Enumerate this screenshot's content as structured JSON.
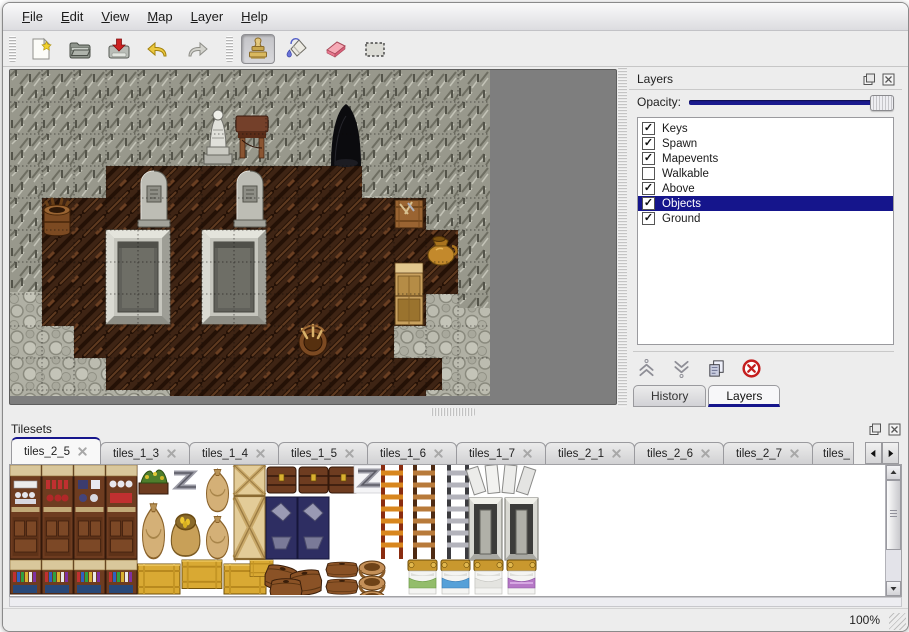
{
  "menu": {
    "items": [
      {
        "label": "File"
      },
      {
        "label": "Edit"
      },
      {
        "label": "View"
      },
      {
        "label": "Map"
      },
      {
        "label": "Layer"
      },
      {
        "label": "Help"
      }
    ]
  },
  "toolbar": {
    "groups": [
      {
        "buttons": [
          {
            "name": "new",
            "icon": "new-file-icon"
          },
          {
            "name": "open",
            "icon": "open-folder-icon"
          },
          {
            "name": "save",
            "icon": "save-icon"
          },
          {
            "name": "undo",
            "icon": "undo-icon"
          },
          {
            "name": "redo",
            "icon": "redo-icon"
          }
        ]
      },
      {
        "buttons": [
          {
            "name": "stamp-tool",
            "icon": "stamp-tool-icon",
            "active": true
          },
          {
            "name": "fill-tool",
            "icon": "fill-tool-icon"
          },
          {
            "name": "eraser-tool",
            "icon": "eraser-tool-icon"
          },
          {
            "name": "select-tool",
            "icon": "select-tool-icon"
          }
        ]
      }
    ]
  },
  "map_view": {
    "tile_size": 32,
    "visible_objects": [
      "statue",
      "table",
      "cave-entrance",
      "gravestone",
      "gravestone",
      "stone-altar",
      "stone-altar",
      "barrel",
      "crate",
      "golden-vase",
      "wooden-shelf",
      "barrel-with-tools"
    ]
  },
  "layers_panel": {
    "title": "Layers",
    "opacity_label": "Opacity:",
    "opacity_percent": 100,
    "layers": [
      {
        "name": "Keys",
        "checked": true,
        "selected": false
      },
      {
        "name": "Spawn",
        "checked": true,
        "selected": false
      },
      {
        "name": "Mapevents",
        "checked": true,
        "selected": false
      },
      {
        "name": "Walkable",
        "checked": false,
        "selected": false
      },
      {
        "name": "Above",
        "checked": true,
        "selected": false
      },
      {
        "name": "Objects",
        "checked": true,
        "selected": true
      },
      {
        "name": "Ground",
        "checked": true,
        "selected": false
      }
    ],
    "buttons": [
      {
        "name": "move-layer-up",
        "icon": "chevrons-up-icon"
      },
      {
        "name": "move-layer-down",
        "icon": "chevrons-down-icon"
      },
      {
        "name": "duplicate-layer",
        "icon": "duplicate-icon"
      },
      {
        "name": "delete-layer",
        "icon": "delete-icon"
      }
    ],
    "tabs": [
      {
        "label": "History",
        "active": false
      },
      {
        "label": "Layers",
        "active": true
      }
    ]
  },
  "tilesets_panel": {
    "title": "Tilesets",
    "tabs": [
      {
        "label": "tiles_2_5",
        "active": true,
        "truncated": false
      },
      {
        "label": "tiles_1_3",
        "active": false,
        "truncated": false
      },
      {
        "label": "tiles_1_4",
        "active": false,
        "truncated": false
      },
      {
        "label": "tiles_1_5",
        "active": false,
        "truncated": false
      },
      {
        "label": "tiles_1_6",
        "active": false,
        "truncated": false
      },
      {
        "label": "tiles_1_7",
        "active": false,
        "truncated": false
      },
      {
        "label": "tiles_2_1",
        "active": false,
        "truncated": false
      },
      {
        "label": "tiles_2_6",
        "active": false,
        "truncated": false
      },
      {
        "label": "tiles_2_7",
        "active": false,
        "truncated": false
      },
      {
        "label": "tiles_",
        "active": false,
        "truncated": true
      }
    ]
  },
  "statusbar": {
    "zoom": "100%"
  },
  "colors": {
    "selection_navy": "#15158c",
    "slider_navy": "#1a1a8e",
    "eraser_pink": "#f2a0ae",
    "delete_red": "#c41e1e",
    "map_background": "#7e7e7e"
  }
}
